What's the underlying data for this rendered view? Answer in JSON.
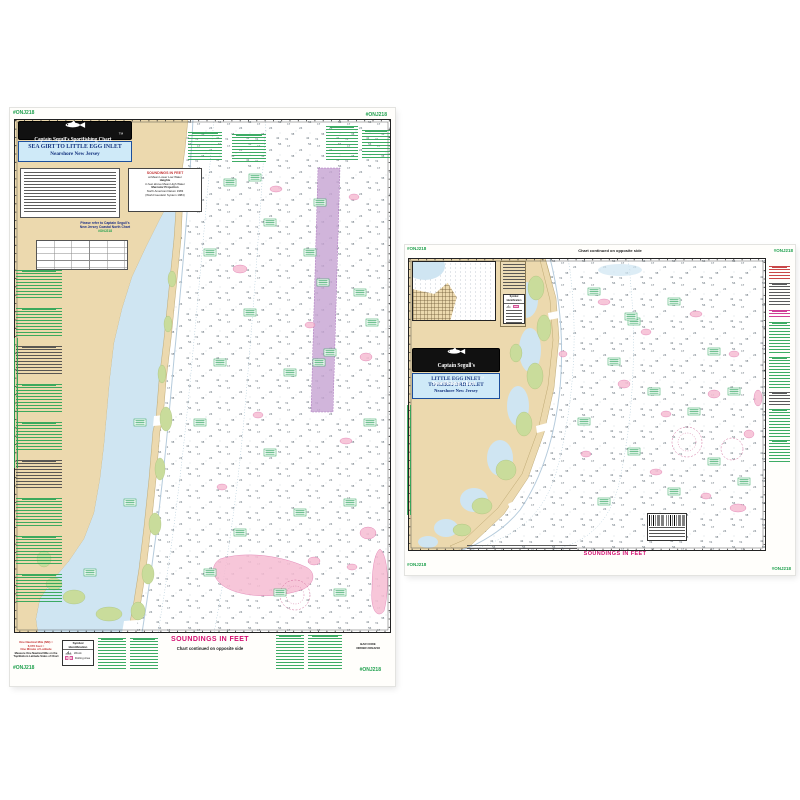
{
  "product": {
    "left_chart": {
      "corner_code": "#ONJ218",
      "brand": "Captain Segull's Sportfishing Chart",
      "trademark": "TM",
      "title": "SEA GIRT TO LITTLE EGG INLET",
      "subtitle": "Nearshore New Jersey",
      "projection_note": {
        "heading": "SOUNDINGS IN FEET",
        "line1": "at Mean Lower Low Water",
        "line2": "Heights",
        "line3": "in feet above Mean High Water",
        "line4": "Mercator Projection",
        "line5": "North American Datum 1983",
        "line6": "(World Geodetic System 1984)"
      },
      "refer_note": {
        "line1": "Please refer to Captain Segull's",
        "line2": "New Jersey Coastal North Chart",
        "line3": "#ONJ218"
      },
      "soundings_label": "SOUNDINGS IN FEET",
      "continued_label": "Chart continued on opposite side",
      "nautical_mile_note": {
        "red1": "One Nautical Mile (NM) =",
        "red2": "6,076 Feet =",
        "red3": "One Minute of Latitude",
        "black1": "Measure One Nautical Mile on the",
        "black2": "Top/Bottom Latitude Sides of Chart"
      },
      "symbol_box": {
        "heading": "Symbol Identification",
        "item1": "Wreck",
        "item2": "Fishing Area"
      },
      "barcode_label1": "BAR CODE",
      "barcode_label2": "ORDER #ONJ218"
    },
    "right_chart": {
      "corner_code": "#ONJ218",
      "brand_line1": "Captain Segull's",
      "brand_line2": "Sportfishing Chart",
      "trademark": "TM",
      "title_line1": "LITTLE EGG INLET",
      "title_line2": "TO HEREFORD INLET",
      "subtitle": "Nearshore New Jersey",
      "continued_label": "Chart continued on opposite side",
      "soundings_label": "SOUNDINGS IN FEET",
      "symbol_box_heading": "Symbol Identification"
    },
    "soundings_texture": {
      "d1": "17",
      "d2": "24",
      "d3": "38",
      "d4": "42",
      "d5": "56",
      "d6": "31"
    }
  }
}
